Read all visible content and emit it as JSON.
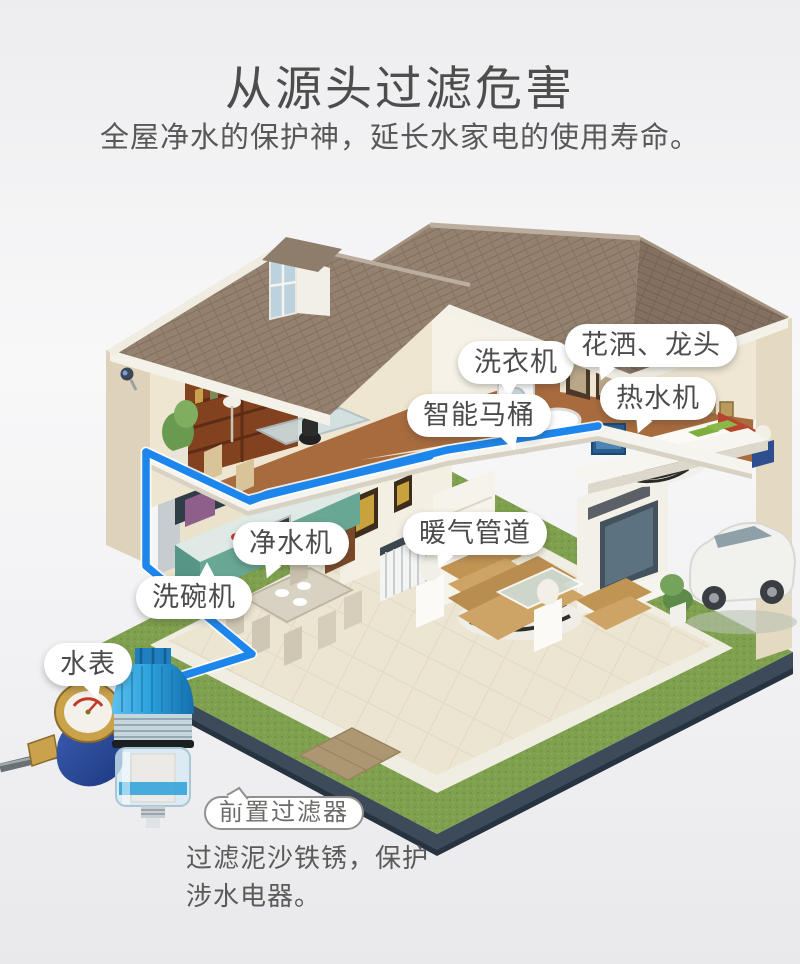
{
  "header": {
    "title": "从源头过滤危害",
    "subtitle": "全屋净水的保护神，延长水家电的使用寿命。"
  },
  "callouts": {
    "washing_machine": "洗衣机",
    "shower_faucet": "花洒、龙头",
    "water_heater": "热水机",
    "smart_toilet": "智能马桶",
    "water_purifier": "净水机",
    "heating_pipes": "暖气管道",
    "dishwasher": "洗碗机",
    "water_meter": "水表",
    "pre_filter": "前置过滤器"
  },
  "product_note": {
    "line1": "过滤泥沙铁锈，保护",
    "line2": "涉水电器。"
  },
  "colors": {
    "pipe_blue": "#1d86ec",
    "title_gray": "#4d4d4d",
    "bubble_text": "#4c4c4c",
    "lawn_green": "#7fa04e",
    "roof_brown": "#8f7d6c",
    "plinth_navy": "#3c4a59",
    "filter_blue": "#2aa0d8"
  }
}
